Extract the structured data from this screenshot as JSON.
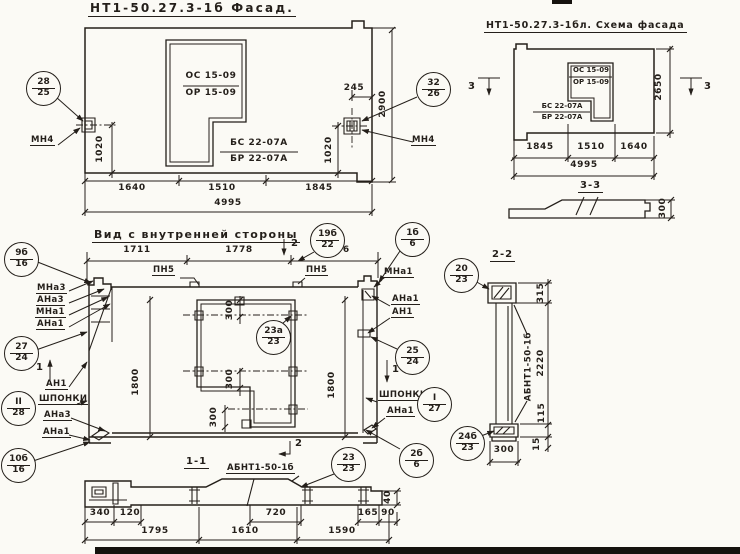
{
  "facade": {
    "title": "НТ1-50.27.3-1б  Фасад.",
    "window": {
      "top": "ОС 15-09",
      "bottom": "ОР 15-09"
    },
    "sill": {
      "top": "БС 22-07А",
      "bottom": "БР 22-07А"
    },
    "callout_left": {
      "num": "28",
      "sheet": "25"
    },
    "callout_right": {
      "num": "32",
      "sheet": "26"
    },
    "anchor_left": "МН4",
    "anchor_right": "МН4",
    "dim_245": "245",
    "dim_2900": "2900",
    "dim_1020_left": "1020",
    "dim_1020_right": "1020",
    "dims": [
      "1640",
      "1510",
      "1845"
    ],
    "dim_total": "4995"
  },
  "schema": {
    "title": "НТ1-50.27.3-1бл. Схема фасада",
    "window": {
      "top": "ОС 15-09",
      "bottom": "ОР 15-09"
    },
    "sill": {
      "top": "БС 22-07А",
      "bottom": "БР 22-07А"
    },
    "marker_left": "3",
    "marker_right": "3",
    "dim_2650": "2650",
    "dims": [
      "1845",
      "1510",
      "1640"
    ],
    "dim_total": "4995",
    "section": {
      "title": "3-3",
      "dim_300": "300"
    }
  },
  "inner": {
    "title": "Вид с внутренней стороны",
    "marker_top": "2",
    "marker_bottom": "2",
    "marker_left": "1",
    "marker_right": "1",
    "dims_top": [
      "1711",
      "1778",
      "1506"
    ],
    "plate_left": "ПН5",
    "plate_right": "ПН5",
    "callouts": {
      "c9b": {
        "num": "9б",
        "sheet": "16"
      },
      "c19b": {
        "num": "19б",
        "sheet": "22"
      },
      "c1b": {
        "num": "1б",
        "sheet": "6"
      },
      "c27": {
        "num": "27",
        "sheet": "24"
      },
      "cII": {
        "num": "II",
        "sheet": "28"
      },
      "c10b": {
        "num": "10б",
        "sheet": "16"
      },
      "c23a": {
        "num": "23а",
        "sheet": "23"
      },
      "c25": {
        "num": "25",
        "sheet": "24"
      },
      "cI": {
        "num": "I",
        "sheet": "27"
      },
      "c2b": {
        "num": "2б",
        "sheet": "6"
      }
    },
    "labels_left": [
      "МНа3",
      "АНа3",
      "МНа1",
      "АНа1"
    ],
    "label_an1_left": "АН1",
    "keys_left": "шпонки",
    "labels_left_bottom": [
      "АНа3",
      "АНа1"
    ],
    "labels_right": [
      "МНа1",
      "АНа1",
      "АН1"
    ],
    "keys_right": "шпонки",
    "label_ana1_right": "АНа1",
    "dim_1800_left": "1800",
    "dim_1800_right": "1800",
    "dim_300_top": "300",
    "dim_300_mid": "300",
    "dim_300_bot": "300"
  },
  "section11": {
    "title": "1-1",
    "label": "АБНТ1-50-1б",
    "callout": {
      "num": "23",
      "sheet": "23"
    },
    "dim_40": "40",
    "dims_small": [
      "340",
      "120",
      "720",
      "165",
      "90"
    ],
    "dims_main": [
      "1795",
      "1610",
      "1590"
    ]
  },
  "section22": {
    "title": "2-2",
    "label": "АБНТ1-50-1б",
    "callout_top": {
      "num": "20",
      "sheet": "23"
    },
    "callout_bottom": {
      "num": "24б",
      "sheet": "23"
    },
    "dim_315": "315",
    "dim_2220": "2220",
    "dim_115": "115",
    "dim_15": "15",
    "dim_300": "300"
  }
}
